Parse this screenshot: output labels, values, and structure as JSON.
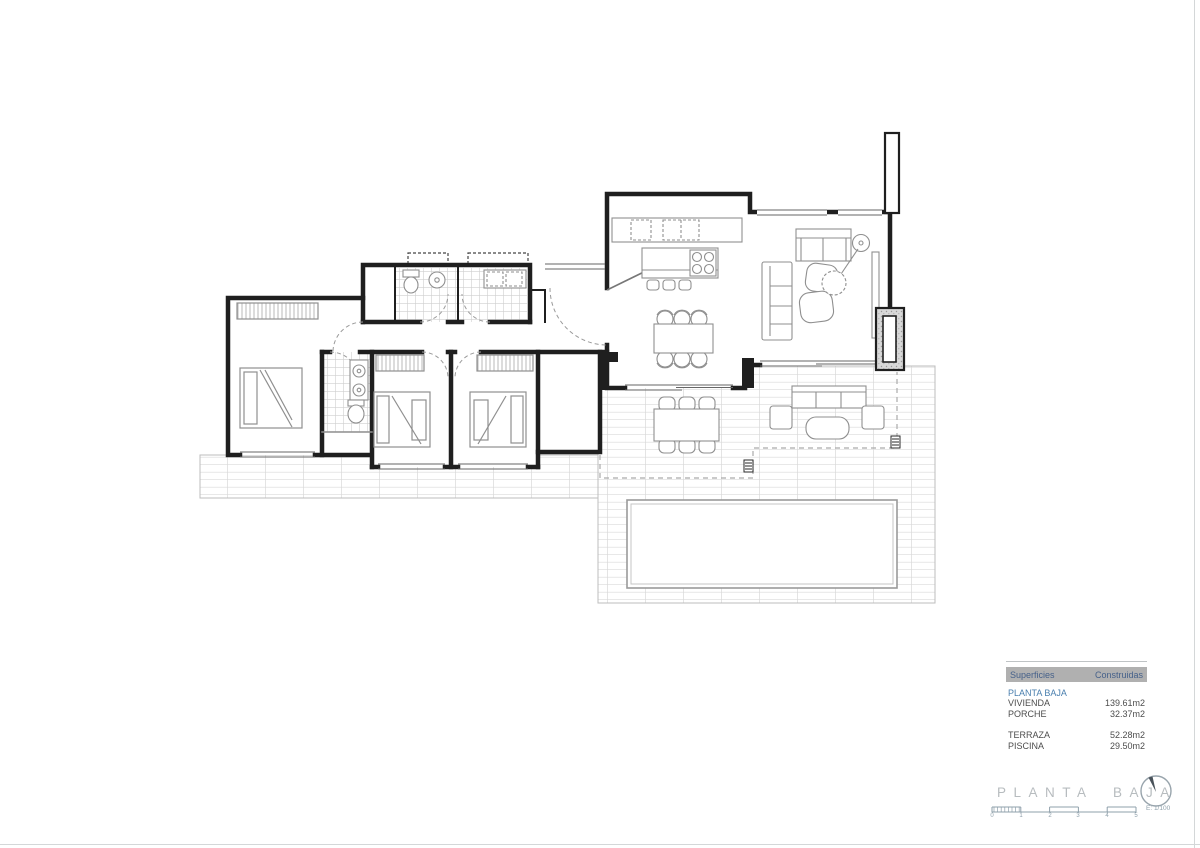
{
  "surfaces_table": {
    "header": {
      "col1": "Superficies",
      "col2": "Construidas"
    },
    "section": "PLANTA BAJA",
    "rows": [
      {
        "label": "VIVIENDA",
        "value": "139.61m2"
      },
      {
        "label": "PORCHE",
        "value": "32.37m2"
      },
      {
        "label": "TERRAZA",
        "value": "52.28m2"
      },
      {
        "label": "PISCINA",
        "value": "29.50m2"
      }
    ]
  },
  "title_block": {
    "title": "PLANTA BAJA",
    "scale": "E: 1/100",
    "ticks": [
      "0",
      "1",
      "2",
      "3",
      "4",
      "5"
    ]
  },
  "colors": {
    "wall": "#1f1f1f",
    "furniture": "#8f8f8f",
    "tile": "#d6d6d6",
    "header_bg": "#b0b0b0",
    "header_text": "#46618a",
    "section_blue": "#4a7fae",
    "title_gray": "#b7bcbf",
    "scale_gray": "#8fa0ab"
  }
}
